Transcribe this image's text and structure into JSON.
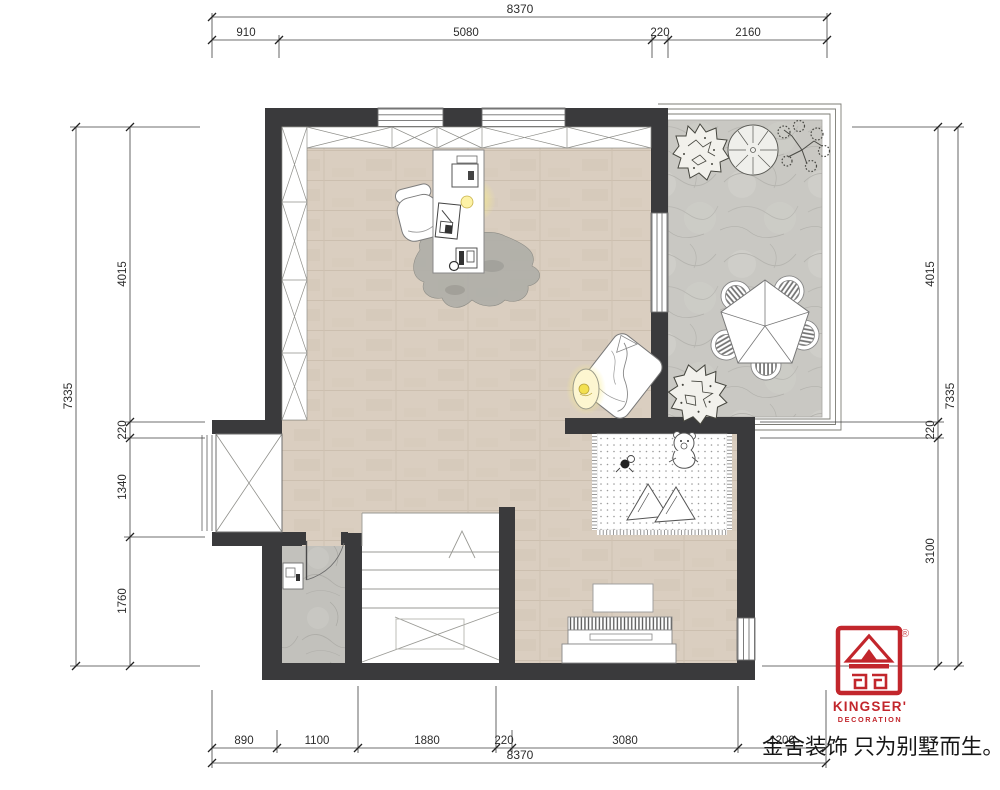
{
  "document": {
    "type": "residential floor plan drawing"
  },
  "dimensions": {
    "top": {
      "total": "8370",
      "segments": [
        "910",
        "5080",
        "220",
        "2160"
      ]
    },
    "bottom": {
      "total": "8370",
      "segments": [
        "890",
        "1100",
        "1880",
        "220",
        "3080",
        "1200"
      ]
    },
    "left": {
      "total": "7335",
      "segments": [
        "4015",
        "220",
        "1340",
        "1760"
      ]
    },
    "right": {
      "total": "7335",
      "segments": [
        "4015",
        "220",
        "3100"
      ]
    }
  },
  "branding": {
    "logo_title": "KINGSER'",
    "logo_subtitle": "DECORATION",
    "registered_mark": "®",
    "slogan": "金舍装饰 只为别墅而生。",
    "logo_color": "#c2262c"
  },
  "colors": {
    "wall": "#3a3a3c",
    "wood_floor": "#dacec0",
    "stone_floor": "#c9c8c3",
    "bath_floor": "#c2c1bc",
    "lamp_glow": "#f6e23d",
    "dimension_line": "#3f3f3f"
  }
}
